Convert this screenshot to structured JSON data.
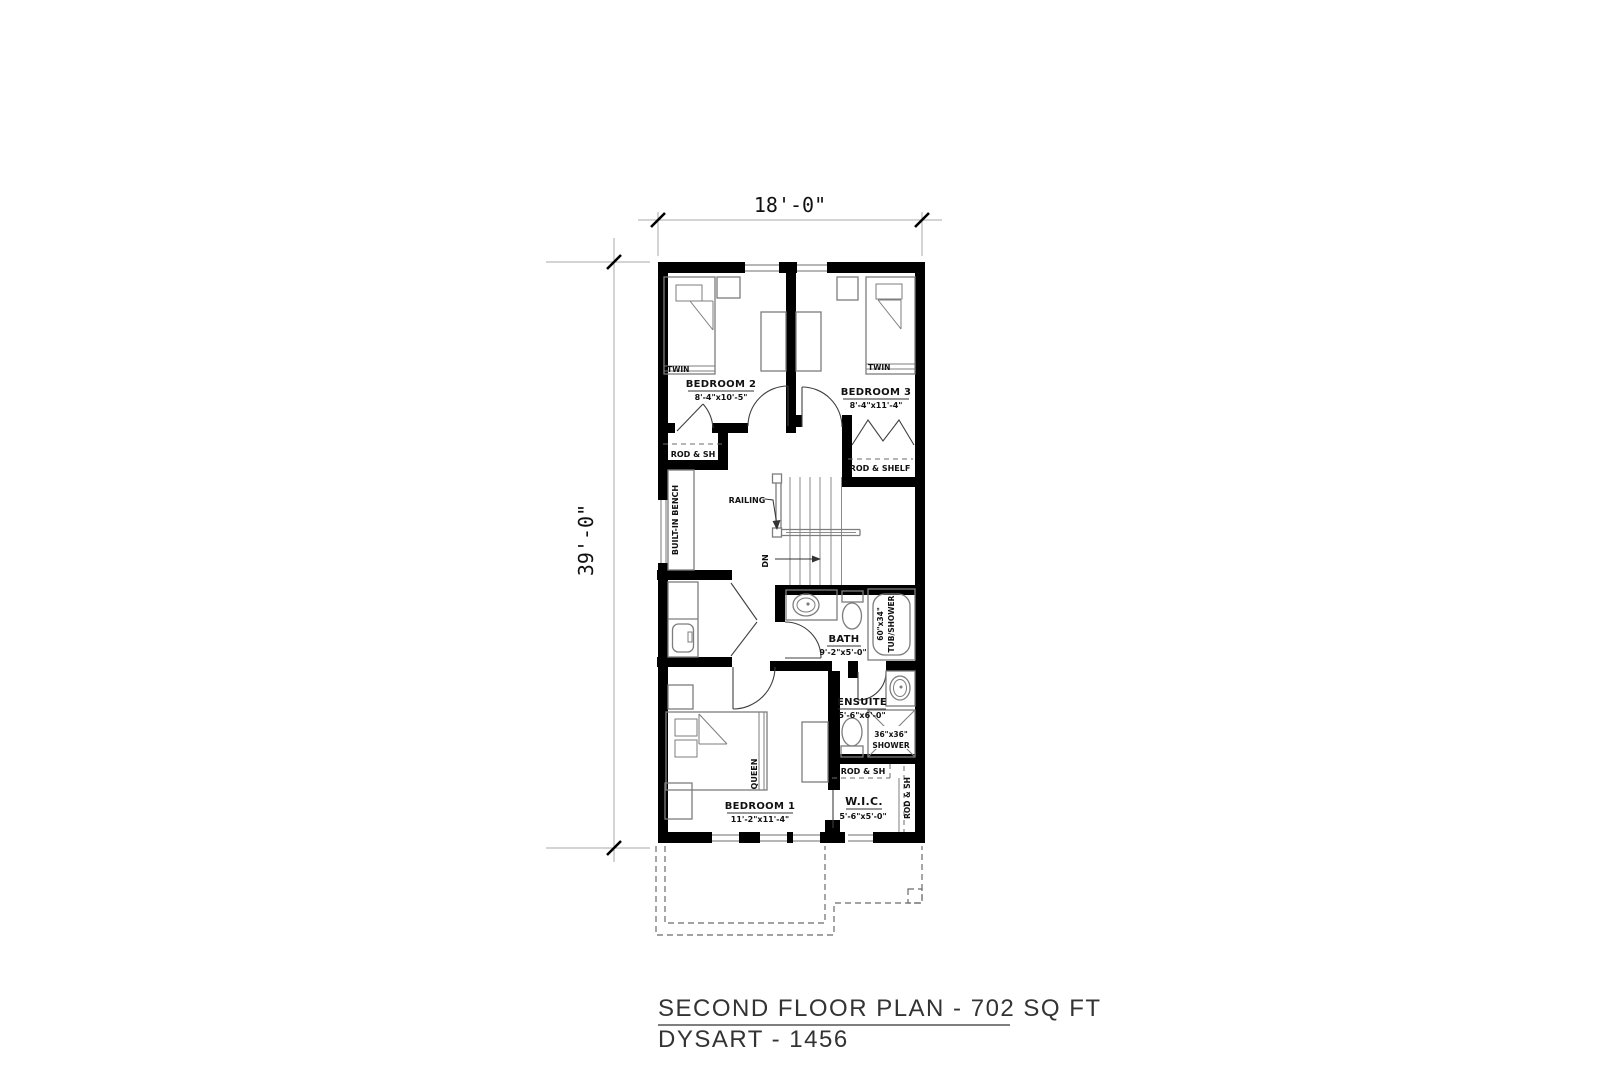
{
  "drawing": {
    "dimensions": {
      "width_label": "18'-0\"",
      "height_label": "39'-0\""
    },
    "rooms": {
      "bedroom2": {
        "name": "BEDROOM 2",
        "size": "8'-4\"x10'-5\""
      },
      "bedroom3": {
        "name": "BEDROOM 3",
        "size": "8'-4\"x11'-4\""
      },
      "bedroom1": {
        "name": "BEDROOM 1",
        "size": "11'-2\"x11'-4\""
      },
      "bath": {
        "name": "BATH",
        "size": "9'-2\"x5'-0\""
      },
      "ensuite": {
        "name": "ENSUITE",
        "size": "5'-6\"x6'-0\""
      },
      "wic": {
        "name": "W.I.C.",
        "size": "5'-6\"x5'-0\""
      }
    },
    "annotations": {
      "twin_left": "TWIN",
      "twin_right": "TWIN",
      "queen": "QUEEN",
      "rod_sh_closet2": "ROD & SH",
      "rod_shelf_closet3": "ROD & SHELF",
      "rod_sh_wic_top": "ROD & SH",
      "rod_sh_wic_side": "ROD & SH",
      "built_in_bench": "BUILT-IN BENCH",
      "railing": "RAILING",
      "down": "DN",
      "tub_size": "60\"x34\"",
      "tub_label": "TUB/SHOWER",
      "shower_size": "36\"x36\"",
      "shower_label": "SHOWER"
    },
    "title": {
      "line1": "SECOND FLOOR PLAN - 702 SQ FT",
      "line2": "DYSART - 1456"
    }
  },
  "colors": {
    "wall": "#000000",
    "furniture": "#7d7d7d",
    "window": "#9e9e9e",
    "dimension": "#a8a8a8",
    "dashed": "#6b6b6b",
    "text": "#111111",
    "title": "#333333"
  }
}
